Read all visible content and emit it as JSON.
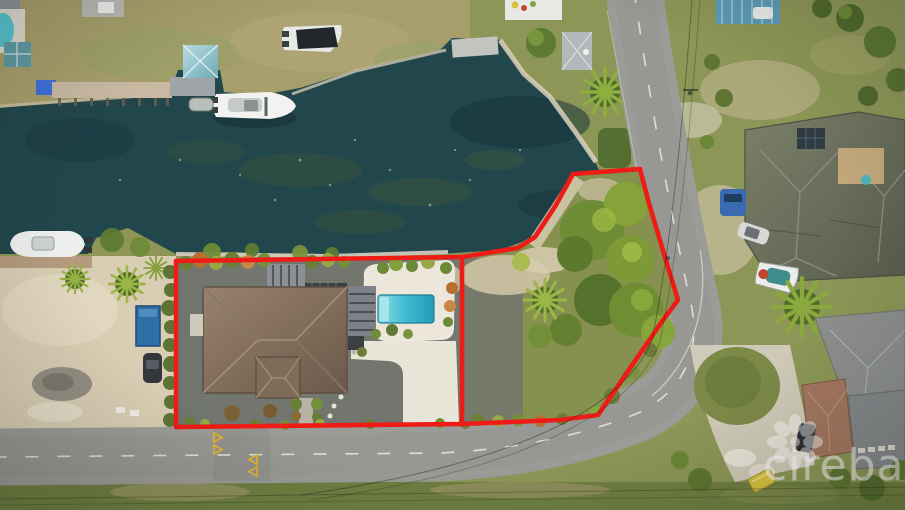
{
  "watermark": {
    "text": "cireba",
    "icon": "cireba-flower-icon"
  },
  "colors": {
    "boundary_red": "#ee1b17",
    "water_deep": "#21464c",
    "road_gray": "#9b9b97",
    "gravel_gray": "#72766f",
    "sand_tan": "#d9cdb3",
    "grass_olive": "#8d9656",
    "roof_brown": "#8a7460",
    "pool_teal": "#36b4c9",
    "deck_white": "#ece7da",
    "chevron_yellow": "#e0b12e",
    "boathouse_teal": "#8fc3cd",
    "container_blue": "#2e6fa8",
    "right_roof_green": "#6e7260",
    "right_roof_brown": "#a3765f",
    "watermark_white": "#ffffff"
  }
}
